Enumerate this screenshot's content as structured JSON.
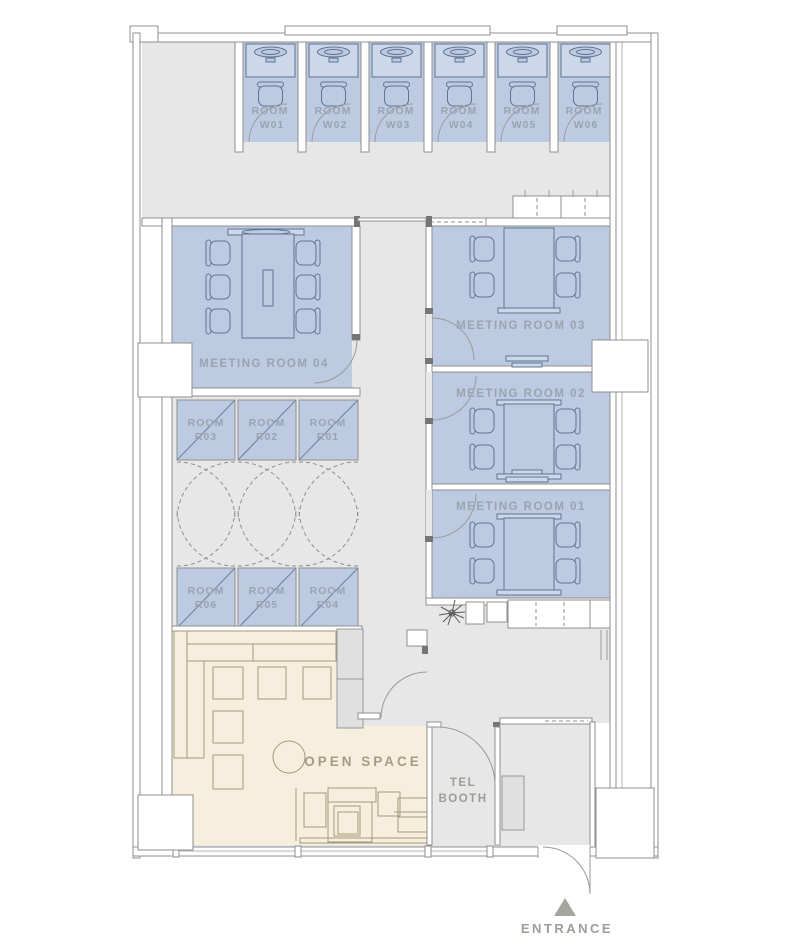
{
  "colors": {
    "floor": "#e7e7e7",
    "room_fill": "#bccbe2",
    "open_space_fill": "#f6efdd",
    "wall_outline": "#8f8f8f",
    "furniture_outline": "#5f7390",
    "room_label": "#9aa3b0",
    "open_space_label": "#a59c88",
    "entrance_label": "#9d9d97"
  },
  "work_rooms": [
    {
      "line1": "ROOM",
      "line2": "W01"
    },
    {
      "line1": "ROOM",
      "line2": "W02"
    },
    {
      "line1": "ROOM",
      "line2": "W03"
    },
    {
      "line1": "ROOM",
      "line2": "W04"
    },
    {
      "line1": "ROOM",
      "line2": "W05"
    },
    {
      "line1": "ROOM",
      "line2": "W06"
    }
  ],
  "meeting_rooms": [
    {
      "label": "MEETING ROOM 04"
    },
    {
      "label": "MEETING ROOM 03"
    },
    {
      "label": "MEETING ROOM 02"
    },
    {
      "label": "MEETING ROOM 01"
    }
  ],
  "storage_rooms": {
    "row1": [
      {
        "line1": "ROOM",
        "line2": "R03"
      },
      {
        "line1": "ROOM",
        "line2": "R02"
      },
      {
        "line1": "ROOM",
        "line2": "R01"
      }
    ],
    "row2": [
      {
        "line1": "ROOM",
        "line2": "R06"
      },
      {
        "line1": "ROOM",
        "line2": "R05"
      },
      {
        "line1": "ROOM",
        "line2": "R04"
      }
    ]
  },
  "areas": {
    "open_space": {
      "label": "OPEN SPACE"
    },
    "tel_booth": {
      "line1": "TEL",
      "line2": "BOOTH"
    },
    "entrance": {
      "label": "ENTRANCE"
    }
  }
}
